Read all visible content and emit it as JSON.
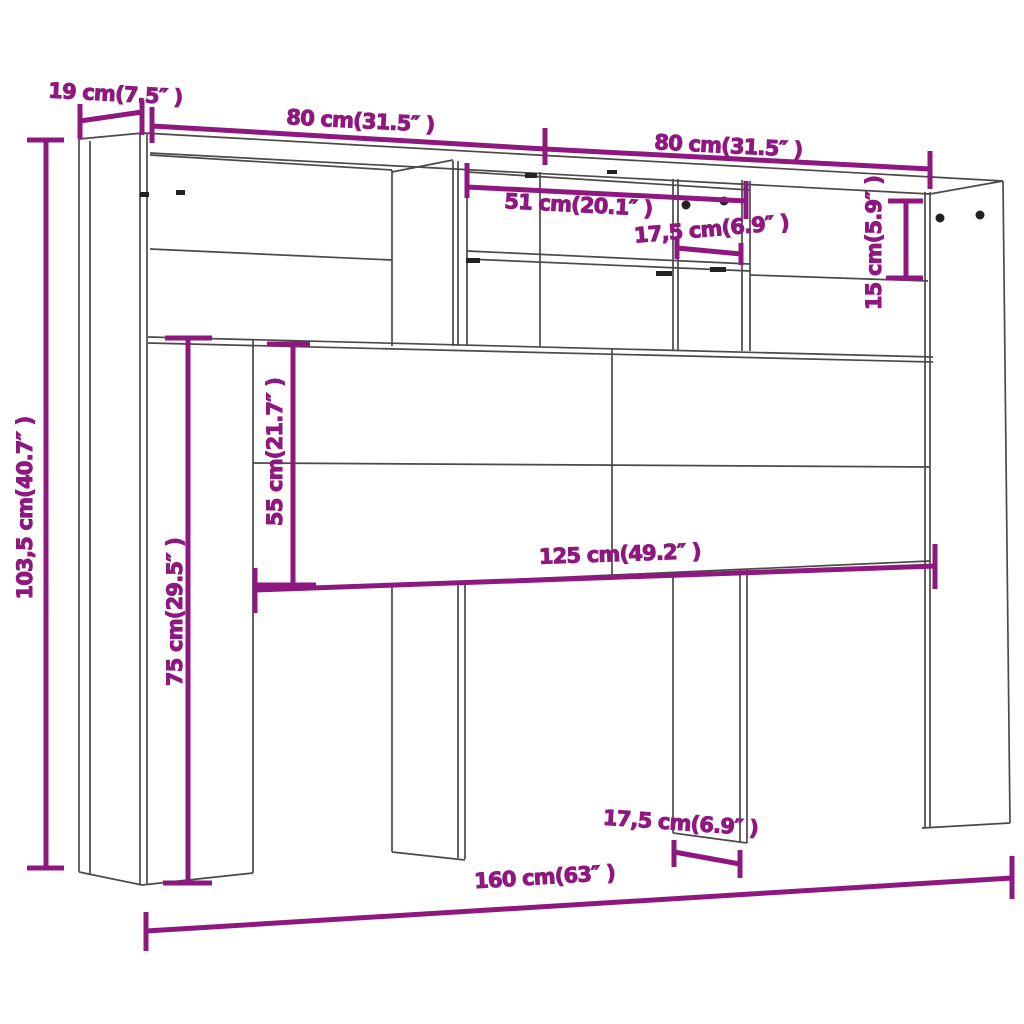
{
  "colors": {
    "dimension": "#8e187f",
    "outline": "#4c4a48",
    "pin": "#222222",
    "background": "#ffffff"
  },
  "dims": {
    "depth": {
      "label": "19 cm(7.5″ )"
    },
    "width_left_top": {
      "label": "80 cm(31.5″ )"
    },
    "width_right_top": {
      "label": "80 cm(31.5″ )"
    },
    "shelf_width": {
      "label": "51 cm(20.1″ )"
    },
    "compartment_width_top": {
      "label": "17,5 cm(6.9″ )"
    },
    "shelf_height_right": {
      "label": "15 cm(5.9″ )"
    },
    "height_total": {
      "label": "103,5 cm(40.7″ )"
    },
    "headboard_height": {
      "label": "55 cm(21.7″ )"
    },
    "clearance_height": {
      "label": "75 cm(29.5″ )"
    },
    "width_inner": {
      "label": "125 cm(49.2″ )"
    },
    "leg_width_bottom": {
      "label": "17,5 cm(6.9″ )"
    },
    "width_total": {
      "label": "160 cm(63″ )"
    }
  }
}
